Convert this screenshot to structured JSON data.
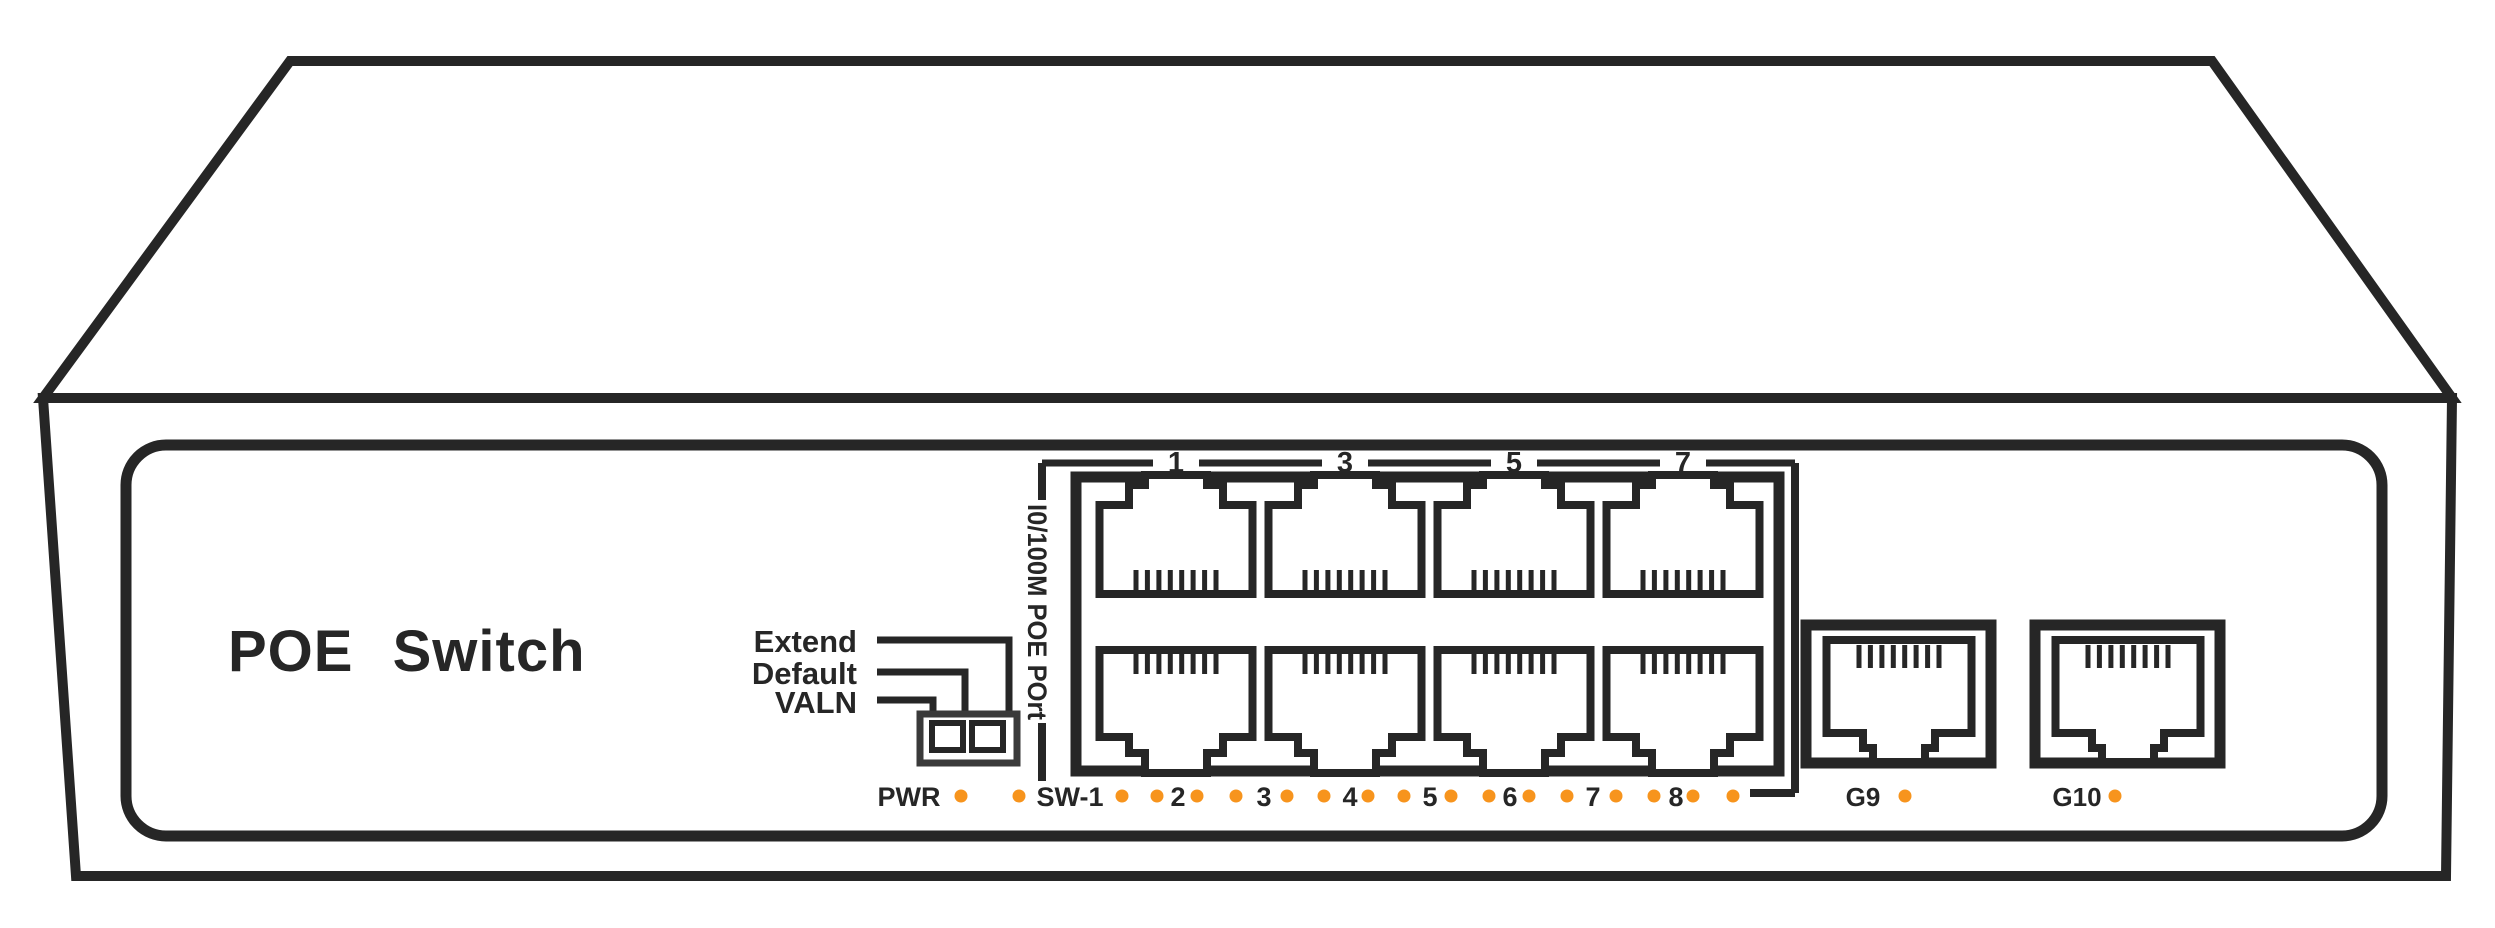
{
  "device": {
    "brand_label": "POE Switch",
    "dip": {
      "labels": [
        "Extend",
        "Default",
        "VALN"
      ]
    },
    "port_group": {
      "vertical_label": "I0/100M POE POrt",
      "top_numbers": [
        "1",
        "3",
        "5",
        "7"
      ],
      "fe_port_count": 8
    },
    "led_row": {
      "power_label": "PWR",
      "port_labels": [
        "SW-1",
        "2",
        "3",
        "4",
        "5",
        "6",
        "7",
        "8"
      ],
      "dot_count": 18
    },
    "uplink": {
      "labels": [
        "G9",
        "G10"
      ]
    },
    "colors": {
      "line": "#262626",
      "led": "#F7941D",
      "background": "#FFFFFF"
    }
  }
}
